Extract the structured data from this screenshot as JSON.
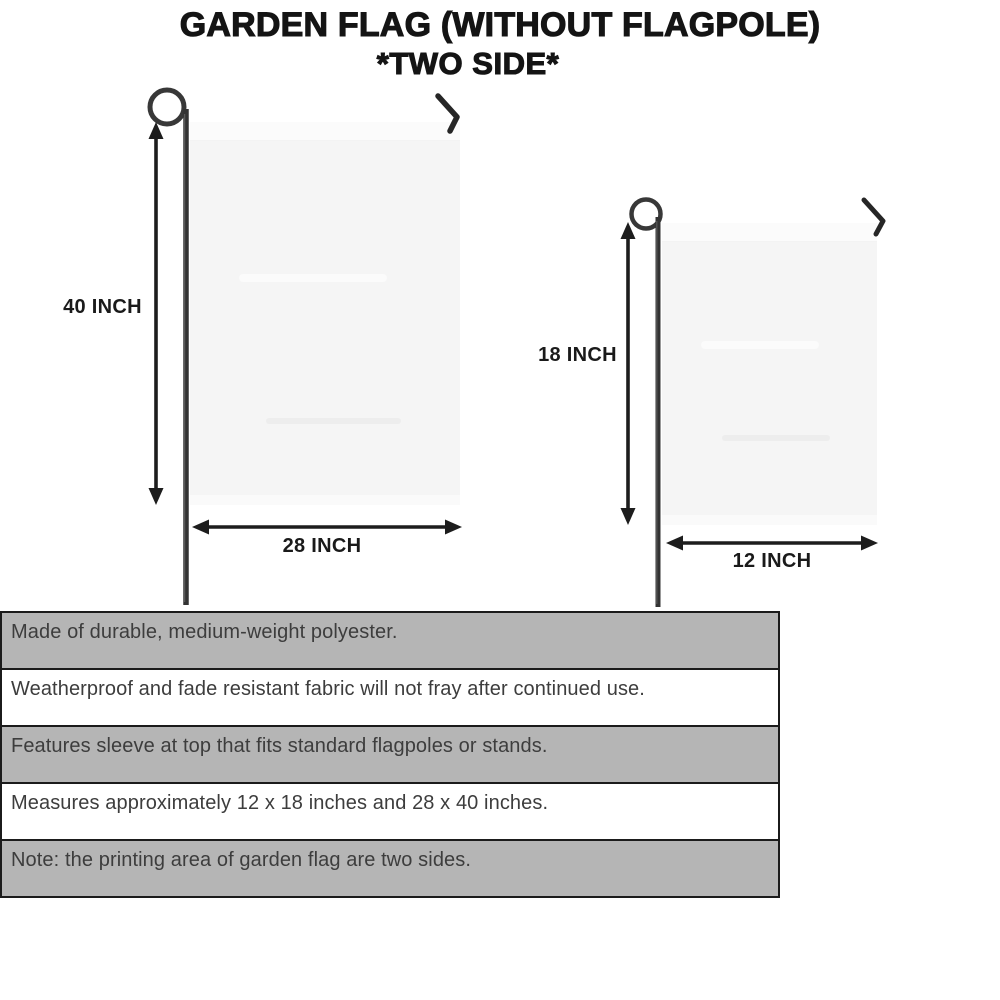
{
  "title": {
    "line1": "GARDEN FLAG (WITHOUT FLAGPOLE)",
    "line2": "*TWO SIDE*"
  },
  "flags": {
    "large": {
      "height_label": "40 INCH",
      "width_label": "28 INCH"
    },
    "small": {
      "height_label": "18 INCH",
      "width_label": "12 INCH"
    }
  },
  "features": [
    {
      "text": "Made of durable, medium-weight polyester.",
      "shaded": true
    },
    {
      "text": "Weatherproof and fade resistant fabric will not fray after continued use.",
      "shaded": false
    },
    {
      "text": "Features sleeve at top that fits standard flagpoles or stands.",
      "shaded": true
    },
    {
      "text": "Measures approximately 12 x 18 inches and 28 x 40 inches.",
      "shaded": false
    },
    {
      "text": "Note: the printing area of garden flag are two sides.",
      "shaded": true
    }
  ],
  "colors": {
    "background": "#ffffff",
    "title_color": "#141414",
    "flag_fill": "#f5f5f5",
    "pole_color": "#383838",
    "arrow_color": "#1d1d1d",
    "label_color": "#1a1a1a",
    "bar_gray": "#b5b5b5",
    "bar_border": "#1b1b1b",
    "feature_text": "#3d3d3d"
  }
}
